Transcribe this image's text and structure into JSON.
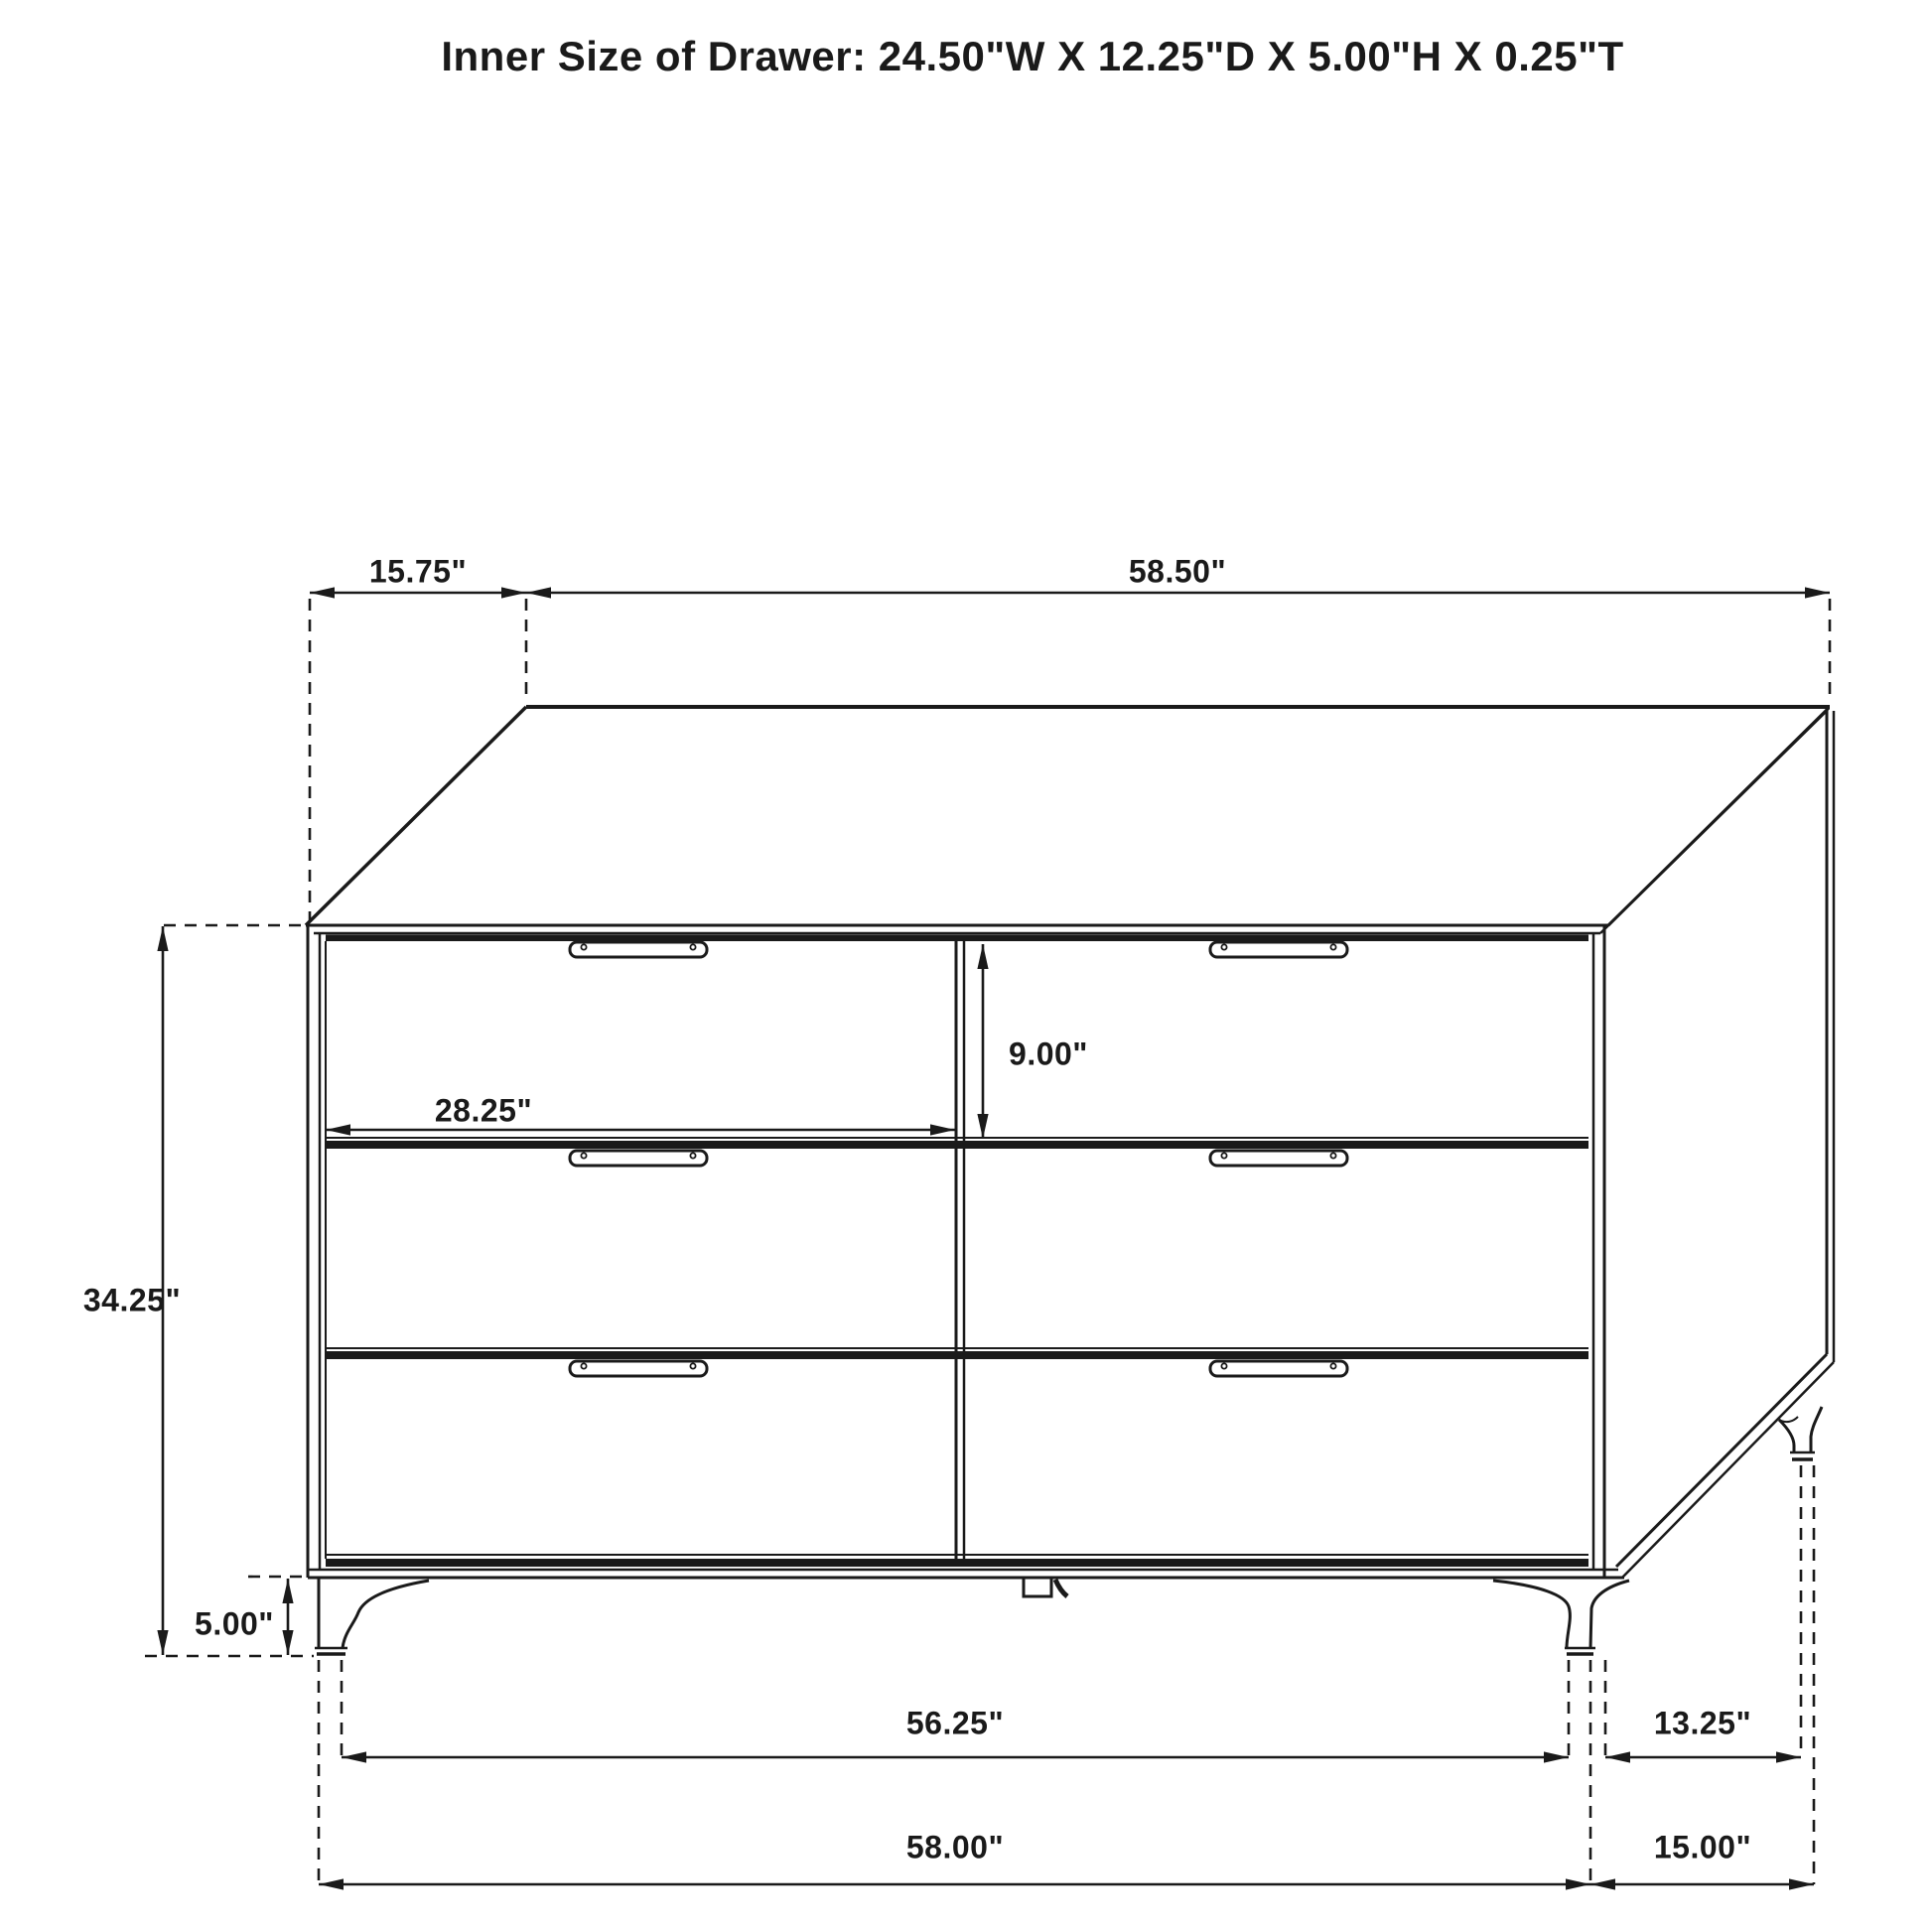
{
  "title": "Inner Size of Drawer: 24.50\"W X 12.25\"D X 5.00\"H X 0.25\"T",
  "figure": {
    "object": "six-drawer dresser",
    "view": "front oblique technical line drawing",
    "drawer_count": 6,
    "drawer_layout": "2 columns x 3 rows"
  },
  "inner_drawer_size": {
    "width": "24.50\"",
    "depth": "12.25\"",
    "height": "5.00\"",
    "thickness": "0.25\""
  },
  "dims": {
    "top_depth": "15.75\"",
    "top_width": "58.50\"",
    "drawer_opening_width": "28.25\"",
    "drawer_front_height": "9.00\"",
    "overall_height": "34.25\"",
    "leg_height": "5.00\"",
    "feet_span_front": "56.25\"",
    "feet_span_side": "13.25\"",
    "base_width": "58.00\"",
    "base_depth": "15.00\""
  },
  "colors": {
    "line": "#1a1a1a",
    "background": "#ffffff"
  }
}
